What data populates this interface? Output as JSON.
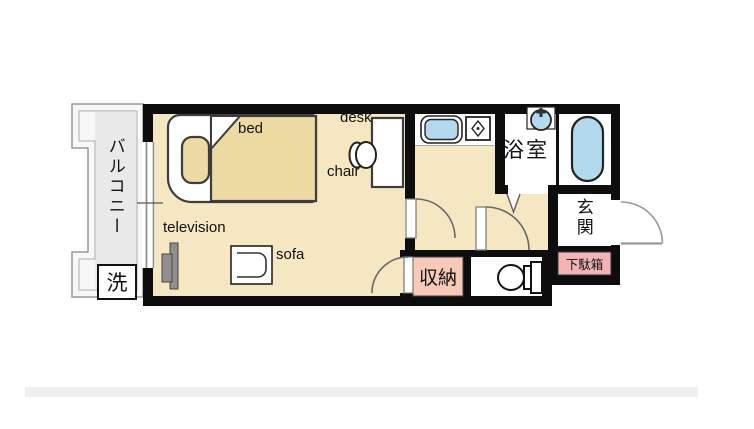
{
  "rooms": {
    "balcony": {
      "label": "バルコニー"
    },
    "washing_machine": {
      "label": "洗"
    },
    "bathroom": {
      "label": "浴室"
    },
    "entrance": {
      "label": "玄関"
    },
    "shoe_cabinet": {
      "label": "下駄箱"
    },
    "storage": {
      "label": "収納"
    }
  },
  "furniture": {
    "bed": {
      "label": "bed"
    },
    "television": {
      "label": "television"
    },
    "sofa": {
      "label": "sofa"
    },
    "desk": {
      "label": "desk"
    },
    "chair": {
      "label": "chair"
    }
  },
  "colors": {
    "wall": "#0d0d0d",
    "floor": "#f4e7c2",
    "blanket": "#ecdaa2",
    "water": "#b3d9ee",
    "storage_pink": "#f6c9b9",
    "shoe_pink": "#f3b4b6",
    "tv": "#8f8f8f",
    "balcony_fill": "#f7f7f7",
    "balcony_deck": "#e9e9e9",
    "balcony_line": "#999999",
    "door_arc": "#666666",
    "outline": "#3d3d3d",
    "strip": "#f0f0f0",
    "label": "#111111"
  }
}
